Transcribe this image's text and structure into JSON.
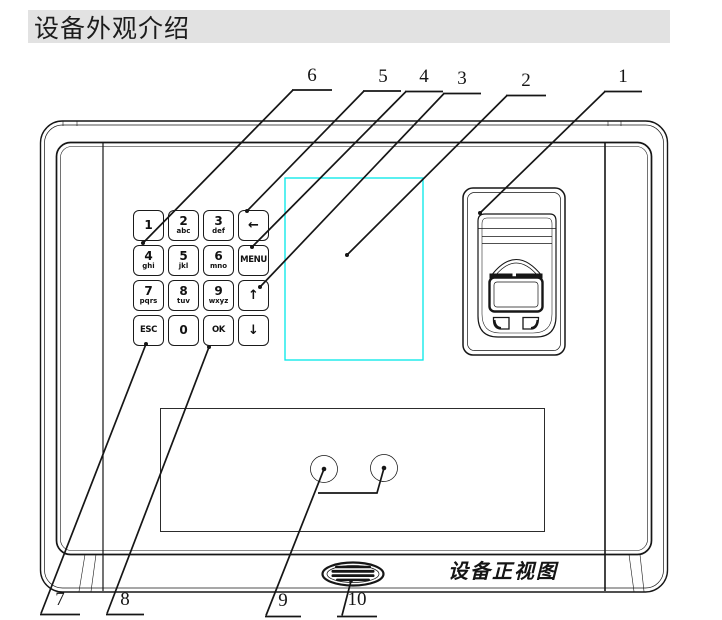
{
  "heading": {
    "text": "设备外观介绍"
  },
  "figure": {
    "caption": "设备正视图",
    "colors": {
      "screen_outline": "#00e8e8",
      "heading_bg": "#e2e2e2",
      "line": "#161616"
    },
    "keypad": {
      "keys": [
        {
          "id": "key-1",
          "main": "1",
          "sub": ""
        },
        {
          "id": "key-2",
          "main": "2",
          "sub": "abc"
        },
        {
          "id": "key-3",
          "main": "3",
          "sub": "def"
        },
        {
          "id": "key-backspace",
          "main": "←",
          "sub": ""
        },
        {
          "id": "key-4",
          "main": "4",
          "sub": "ghi"
        },
        {
          "id": "key-5",
          "main": "5",
          "sub": "jkl"
        },
        {
          "id": "key-6",
          "main": "6",
          "sub": "mno"
        },
        {
          "id": "key-menu",
          "main": "MENU",
          "sub": ""
        },
        {
          "id": "key-7",
          "main": "7",
          "sub": "pqrs"
        },
        {
          "id": "key-8",
          "main": "8",
          "sub": "tuv"
        },
        {
          "id": "key-9",
          "main": "9",
          "sub": "wxyz"
        },
        {
          "id": "key-up",
          "main": "↑",
          "sub": ""
        },
        {
          "id": "key-esc",
          "main": "ESC",
          "sub": ""
        },
        {
          "id": "key-0",
          "main": "0",
          "sub": ""
        },
        {
          "id": "key-ok",
          "main": "OK",
          "sub": ""
        },
        {
          "id": "key-down",
          "main": "↓",
          "sub": ""
        }
      ]
    },
    "callouts": [
      {
        "n": "6"
      },
      {
        "n": "5"
      },
      {
        "n": "4"
      },
      {
        "n": "3"
      },
      {
        "n": "2"
      },
      {
        "n": "1"
      },
      {
        "n": "7"
      },
      {
        "n": "8"
      },
      {
        "n": "9"
      },
      {
        "n": "10"
      }
    ]
  }
}
